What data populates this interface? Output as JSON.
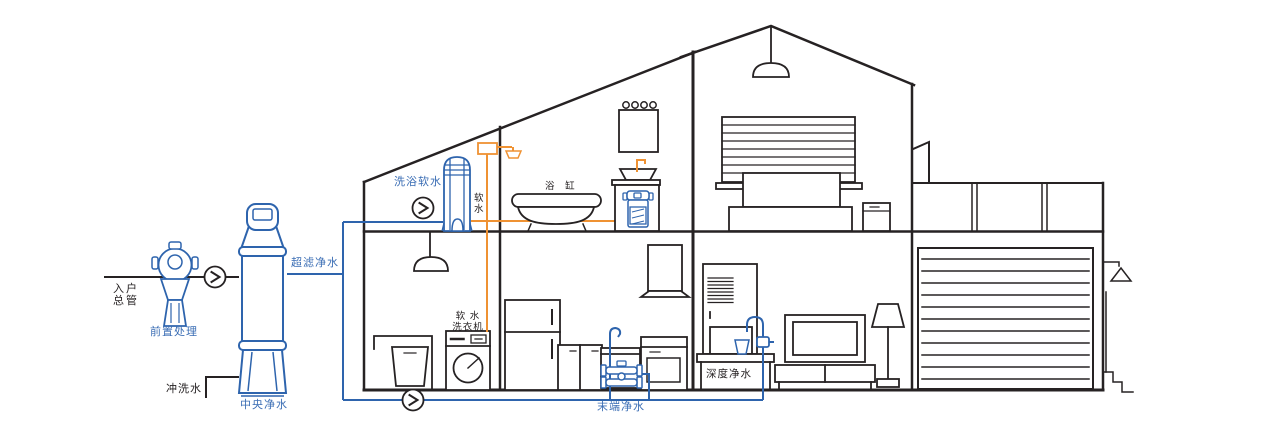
{
  "diagram": {
    "type": "whole-house water purification system cutaway illustration",
    "labels": {
      "inlet_main": "入户\n总管",
      "pre_treatment": "前置处理",
      "flush_water": "冲洗水",
      "central_purification": "中央净水",
      "ultrafiltration": "超滤净水",
      "shower_softening": "洗浴软水",
      "soft_water": "软\n水",
      "bathtub": "浴 缸",
      "soft_water_washer": "软 水\n洗衣机",
      "terminal_purification": "末端净水",
      "deep_purification": "深度净水"
    },
    "icons": {
      "flow_indicator": "chevron-right-in-circle",
      "count_flow_indicators": 3
    }
  },
  "colors": {
    "line_black": "#262223",
    "pipe_blue": "#2e64ad",
    "label_blue": "#3a6db4",
    "soft_water_orange": "#ef9233"
  }
}
